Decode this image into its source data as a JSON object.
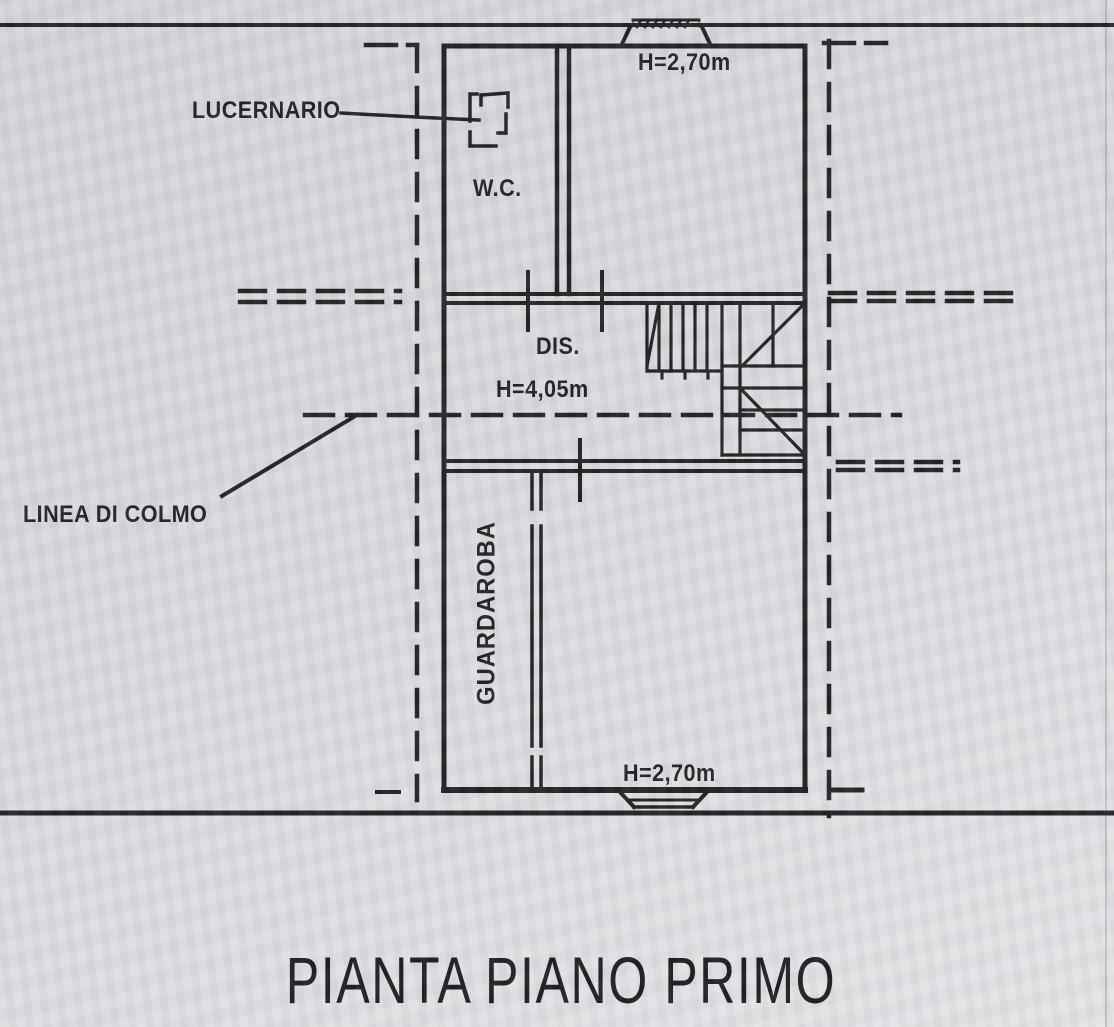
{
  "page": {
    "title": "PIANTA PIANO PRIMO"
  },
  "plan": {
    "rooms": {
      "wc": "W.C.",
      "dis": "DIS.",
      "guardaroba": "GUARDAROBA"
    },
    "heights": {
      "top_room": "H=2,70m",
      "dis": "H=4,05m",
      "bottom_room": "H=2,70m"
    },
    "annotations": {
      "lucernario": "LUCERNARIO",
      "linea_di_colmo": "LINEA DI COLMO"
    }
  },
  "colors": {
    "paper": "#d8dade",
    "ink": "#1b1b1d"
  }
}
